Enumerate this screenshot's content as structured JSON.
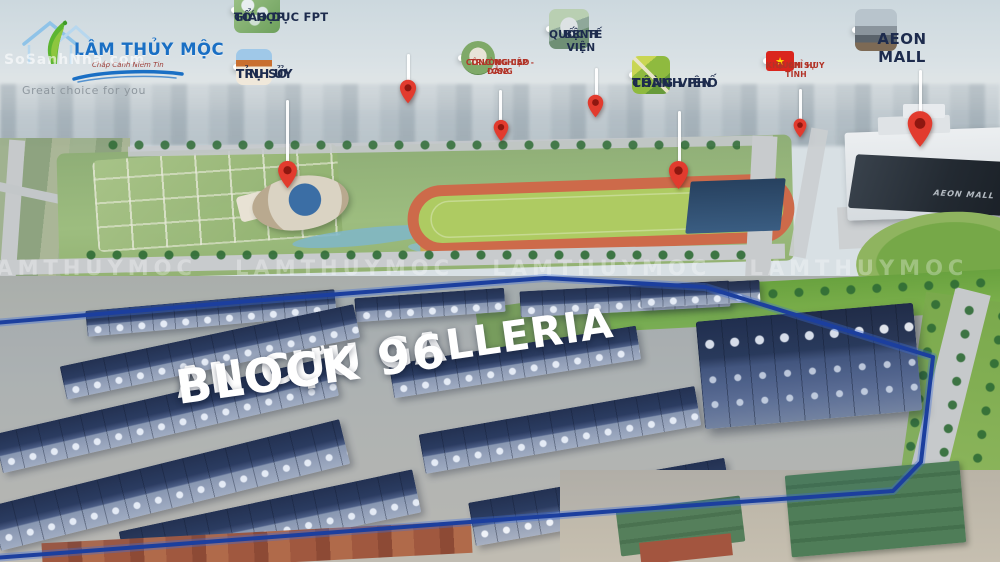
{
  "branding": {
    "name": "LÂM THỦY MỘC",
    "slogan": "Chắp Cánh Niềm Tin",
    "tagline": "Great choice for you",
    "site_watermark": "SoSanhNha.com"
  },
  "hero": {
    "title_line1": "AN CỰU GALLERIA",
    "title_line2": "BLOCK 96"
  },
  "watermark_band": "LAMTHUYMOC LAMTHUYMOC LAMTHUYMOC LAMTHUYMOC LAMTHUYMOC LAMTHUYMOC",
  "landmarks": {
    "fpt": {
      "line1": "TỔ HỢP",
      "line2": "GIÁO DỤC FPT"
    },
    "tinh_uy": {
      "line1": "TRỤ SỞ",
      "line2": "TỈNH ỦY"
    },
    "cao_dang": {
      "line1": "TRƯỜNG CAO ĐẲNG",
      "line2": "CÔNG NGHIỆP - CS2"
    },
    "benh_vien": {
      "line1": "BỆNH VIỆN",
      "line2": "QUỐC TẾ"
    },
    "cong_vien": {
      "line1": "CÔNG VIÊN",
      "line2": "THÀNH PHỐ"
    },
    "quan_su": {
      "line1": "KHU CHỈ HUY",
      "line2": "QUÂN SỰ TỈNH",
      "flag_star": "★"
    },
    "aeon": {
      "line1": "AEON MALL",
      "building_text": "AEON MALL"
    }
  },
  "colors": {
    "pin": "#e23b2e",
    "pin_inner": "#8f1710",
    "boundary": "#1c3f9e",
    "label_text": "#1d2b4d",
    "label_text_red": "#b23327",
    "brand_blue": "#1a6fc4",
    "brand_green": "#5cb531"
  }
}
